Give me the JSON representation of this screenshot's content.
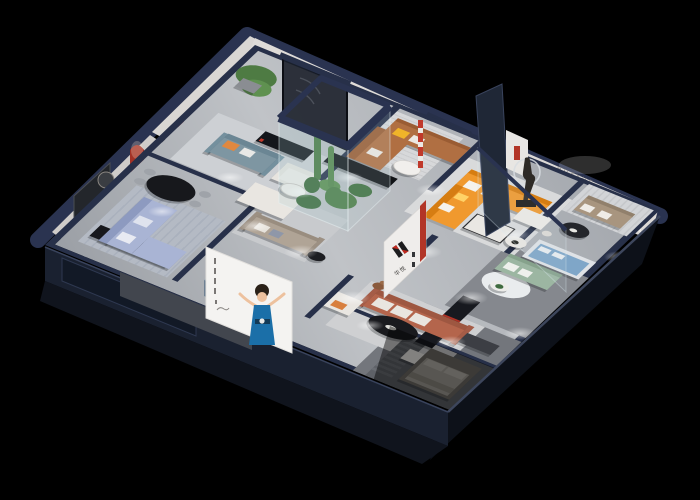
{
  "scene": {
    "type": "isometric-cutaway-showroom-render",
    "description": "3D bird's-eye cutaway rendering of a furniture showroom apartment on a black background",
    "background_color": "#000000"
  },
  "brand": {
    "logo_mark": "red-black-double-bar-monogram",
    "logo_caption": "华悦",
    "wall_letters": "HUAYUE"
  },
  "palette": {
    "outer_wall_cap": "#2a3350",
    "outer_wall_face_dark": "#0d1119",
    "front_band": "#1a2130",
    "floor": "#a9adb3",
    "interior_wall": "#dcd9d6",
    "accent_arch_red": "#a33226",
    "accent_logo_red": "#c2281e",
    "sofa_orange": "#f0992e",
    "sofa_periwinkle": "#a9b4d4",
    "sofa_teal": "#7e96a2",
    "sofa_caramel": "#b06f42",
    "sofa_terracotta": "#b4654c",
    "sofa_sage": "#9cb6a2",
    "sofa_taupe": "#b0a496",
    "green_display_band": "#9cb9a6",
    "mattress_blue": "#7fa6c8",
    "poster_dress_blue": "#1b6fa8",
    "ottoman_slate_blue": "#8b9cae",
    "plant_green": "#4c7d44"
  },
  "rooms": [
    {
      "name": "living-room-blue",
      "furniture": [
        "periwinkle-sectional-sofa",
        "white-pillows",
        "black-oval-dining-table",
        "dining-chairs",
        "black-media-console",
        "dark-tv-wall-panel",
        "round-wall-art",
        "red-arch-niche"
      ]
    },
    {
      "name": "lounge-teal",
      "furniture": [
        "potted-tree",
        "teal-sofa",
        "orange-pillow",
        "cream-armchair",
        "white-sofa",
        "round-coffee-table",
        "black-media-console",
        "red-floor-lamp",
        "curved-wall-line-art"
      ]
    },
    {
      "name": "lounge-caramel",
      "furniture": [
        "caramel-corner-sofa",
        "yellow-pillow",
        "white-pillows",
        "round-coffee-table",
        "smoked-glass-door",
        "red-arch-niche-with-figurine",
        "small-wall-caption"
      ]
    },
    {
      "name": "atrium",
      "furniture": [
        "glass-enclosure",
        "cacti-and-plants"
      ]
    },
    {
      "name": "lounge-taupe",
      "furniture": [
        "taupe-sofa",
        "black-side-table",
        "long-black-console"
      ]
    },
    {
      "name": "living-room-orange",
      "furniture": [
        "orange-sectional-sofa",
        "white-pillows",
        "marble-coffee-table",
        "sculpture-with-ring-light",
        "navy-partition-wall",
        "white-art-panel",
        "red-striped-pole"
      ]
    },
    {
      "name": "lounge-huayue",
      "furniture": [
        "wall-letters",
        "green-recessed-display-band",
        "taupe-loveseat",
        "dark-round-coffee-table",
        "white-dining-table",
        "dining-chairs",
        "round-side-table"
      ]
    },
    {
      "name": "lounge-green",
      "furniture": [
        "sage-green-sofa",
        "blue-mattress-display",
        "glass-partition",
        "round-white-rug",
        "plant-side-table"
      ]
    },
    {
      "name": "living-room-terracotta",
      "furniture": [
        "terracotta-sofa",
        "white-cushions",
        "black-oval-coffee-table",
        "white-bench",
        "cream-armchair-orange-pillow",
        "teddy-bear-figure",
        "logo-wall",
        "black-media-wall-red-stripes"
      ]
    },
    {
      "name": "bedroom-dim",
      "furniture": [
        "bed",
        "pillows",
        "striped-rug",
        "dark-dresser"
      ]
    },
    {
      "name": "front-walkway",
      "furniture": [
        "poster-woman-in-blue-dress",
        "slate-blue-cube-ottoman",
        "dark-display-window"
      ]
    }
  ],
  "poster": {
    "figure": "woman-in-blue-dress-arms-raised",
    "panel_color": "#f4f3f1",
    "side_marks": "small-vertical-caption-marks"
  }
}
